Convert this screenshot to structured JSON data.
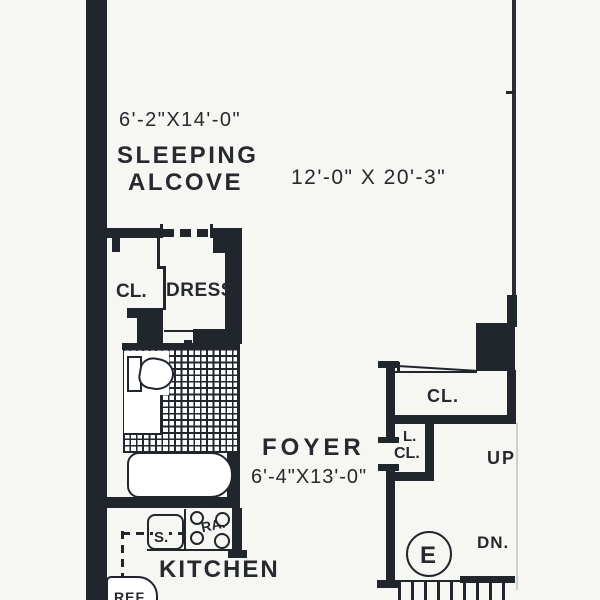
{
  "plan": {
    "title": "Apartment floor plan",
    "colors": {
      "wall": "#21252c",
      "ink": "#26292e",
      "paper": "#f6f6f3"
    },
    "rooms": {
      "sleeping_alcove": {
        "name_line1": "SLEEPING",
        "name_line2": "ALCOVE",
        "dims": "6'-2\"X14'-0\""
      },
      "living_area": {
        "dims": "12'-0\" X 20'-3\""
      },
      "closet": {
        "label": "CL."
      },
      "dressing": {
        "label": "DRESS."
      },
      "foyer": {
        "name": "FOYER",
        "dims": "6'-4\"X13'-0\""
      },
      "kitchen": {
        "name": "KITCHEN"
      },
      "foyer_closet": {
        "label": "CL."
      },
      "linen_closet": {
        "line1": "L.",
        "line2": "CL."
      }
    },
    "stairs": {
      "up": "UP",
      "down": "DN."
    },
    "fixtures": {
      "sink": "S.",
      "range": "RA.",
      "refrigerator": "REF",
      "elevator": "E"
    }
  }
}
